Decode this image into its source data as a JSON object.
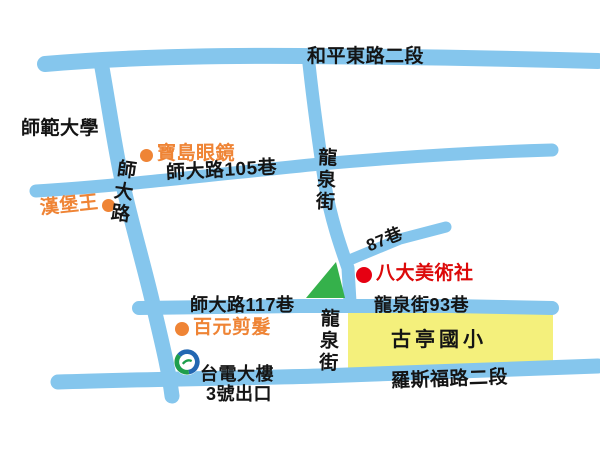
{
  "roads": {
    "heping": {
      "name": "和平東路二段"
    },
    "shida": {
      "name": "師大路"
    },
    "longquan_north": {
      "name": "龍泉街"
    },
    "lane105": {
      "name": "師大路105巷"
    },
    "lane87": {
      "name": "87巷"
    },
    "lane117": {
      "name": "師大路117巷"
    },
    "longquan93": {
      "name": "龍泉街93巷"
    },
    "longquan_south": {
      "name": "龍泉街"
    },
    "roosevelt": {
      "name": "羅斯福路二段"
    }
  },
  "places": {
    "university": {
      "name": "師範大學"
    },
    "glasses_shop": {
      "name": "寶島眼鏡",
      "marker": "orange-dot"
    },
    "burger_king": {
      "name": "漢堡王",
      "marker": "orange-dot"
    },
    "haircut": {
      "name": "百元剪髮",
      "marker": "orange-dot"
    },
    "destination": {
      "name": "八大美術社",
      "marker": "red-dot"
    },
    "school": {
      "name": "古亭國小",
      "area": "yellow-block"
    },
    "park": {
      "name": "green-triangle"
    },
    "metro_station": {
      "name": "台電大樓",
      "exit": "3號出口",
      "marker": "metro-logo-icon"
    }
  },
  "colors": {
    "road": "#85c6ed",
    "school_area": "#f4f07c",
    "park_green": "#35b14b",
    "destination_red": "#e60012",
    "poi_orange": "#ef8435",
    "metro_blue": "#2267b2",
    "metro_green": "#1e9e4c",
    "text_black": "#141414",
    "background": "#ffffff"
  }
}
